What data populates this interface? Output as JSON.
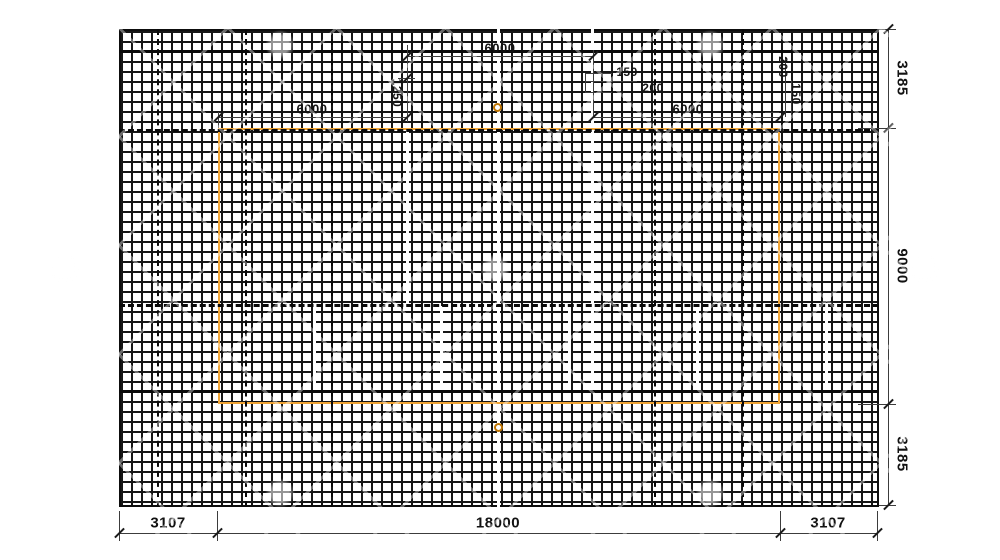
{
  "meta": {
    "kind": "reinforcement-mesh-layout-plan",
    "units": "mm"
  },
  "colors": {
    "grid_line": "#161616",
    "heavy_line": "#0a0a0a",
    "dim_line": "#3c3c3c",
    "text": "#121212",
    "outline_orange": "#f0a435",
    "circle_orange": "#bf7400",
    "background": "#ffffff"
  },
  "drawing": {
    "mesh": {
      "x": 119,
      "y": 29,
      "w": 760,
      "h": 478
    },
    "inner_outline": {
      "x": 218,
      "y": 128,
      "w": 562,
      "h": 276
    },
    "heavy_hlines": [
      {
        "x1": 119,
        "x2": 879,
        "y": 51,
        "t": 3,
        "style": "solid"
      },
      {
        "x1": 119,
        "x2": 879,
        "y": 130,
        "t": 3,
        "style": "dashed"
      },
      {
        "x1": 119,
        "x2": 879,
        "y": 305,
        "t": 3,
        "style": "dashed"
      },
      {
        "x1": 119,
        "x2": 879,
        "y": 391,
        "t": 3,
        "style": "solid"
      }
    ],
    "dashed_vlines": [
      {
        "x": 158,
        "y1": 29,
        "y2": 507
      },
      {
        "x": 246,
        "y1": 29,
        "y2": 507
      },
      {
        "x": 332,
        "y1": 29,
        "y2": 507
      },
      {
        "x": 655,
        "y1": 29,
        "y2": 507
      },
      {
        "x": 743,
        "y1": 29,
        "y2": 507
      }
    ],
    "seams": [
      {
        "x": 407,
        "y1": 130,
        "y2": 306
      },
      {
        "x": 498,
        "y1": 29,
        "y2": 507
      },
      {
        "x": 592,
        "y1": 29,
        "y2": 391
      },
      {
        "x": 314,
        "y1": 306,
        "y2": 391
      },
      {
        "x": 441,
        "y1": 306,
        "y2": 391
      },
      {
        "x": 569,
        "y1": 306,
        "y2": 391
      },
      {
        "x": 697,
        "y1": 306,
        "y2": 391
      },
      {
        "x": 826,
        "y1": 306,
        "y2": 391
      }
    ],
    "circles": [
      {
        "cx": 497,
        "cy": 107,
        "d": 9
      },
      {
        "cx": 498,
        "cy": 427,
        "d": 9
      }
    ],
    "dim_hlines": [
      {
        "x1": 119,
        "x2": 877,
        "y": 533
      },
      {
        "x1": 218,
        "x2": 407,
        "y": 117
      },
      {
        "x1": 407,
        "x2": 593,
        "y": 56
      },
      {
        "x1": 593,
        "x2": 780,
        "y": 117
      },
      {
        "x1": 585,
        "x2": 612,
        "y": 73
      },
      {
        "x1": 585,
        "x2": 637,
        "y": 81
      },
      {
        "x1": 585,
        "x2": 612,
        "y": 92
      },
      {
        "x1": 765,
        "x2": 779,
        "y": 112
      },
      {
        "x1": 398,
        "x2": 415,
        "y": 78
      },
      {
        "x1": 879,
        "x2": 896,
        "y": 29
      },
      {
        "x1": 858,
        "x2": 896,
        "y": 128
      },
      {
        "x1": 858,
        "x2": 896,
        "y": 404
      },
      {
        "x1": 879,
        "x2": 896,
        "y": 505
      }
    ],
    "dim_vlines": [
      {
        "x": 888,
        "y1": 29,
        "y2": 505
      },
      {
        "x": 119,
        "y1": 511,
        "y2": 541
      },
      {
        "x": 217,
        "y1": 511,
        "y2": 541
      },
      {
        "x": 780,
        "y1": 511,
        "y2": 541
      },
      {
        "x": 877,
        "y1": 511,
        "y2": 541
      },
      {
        "x": 407,
        "y1": 45,
        "y2": 122
      },
      {
        "x": 593,
        "y1": 50,
        "y2": 117
      },
      {
        "x": 218,
        "y1": 112,
        "y2": 128
      },
      {
        "x": 785,
        "y1": 58,
        "y2": 117
      },
      {
        "x": 791,
        "y1": 80,
        "y2": 117
      },
      {
        "x": 585,
        "y1": 73,
        "y2": 92
      }
    ],
    "ticks": [
      {
        "x": 119,
        "y": 533
      },
      {
        "x": 217,
        "y": 533
      },
      {
        "x": 780,
        "y": 533
      },
      {
        "x": 877,
        "y": 533
      },
      {
        "x": 888,
        "y": 29
      },
      {
        "x": 888,
        "y": 128
      },
      {
        "x": 888,
        "y": 404
      },
      {
        "x": 888,
        "y": 505
      },
      {
        "x": 218,
        "y": 117
      },
      {
        "x": 407,
        "y": 117
      },
      {
        "x": 407,
        "y": 56
      },
      {
        "x": 593,
        "y": 56
      },
      {
        "x": 593,
        "y": 117
      },
      {
        "x": 780,
        "y": 117
      },
      {
        "x": 407,
        "y": 78
      }
    ],
    "labels": [
      {
        "name": "dim-bottom-left",
        "text": "3107",
        "x": 168,
        "y": 523,
        "rot": 0,
        "size": 15
      },
      {
        "name": "dim-bottom-center",
        "text": "18000",
        "x": 498,
        "y": 523,
        "rot": 0,
        "size": 15
      },
      {
        "name": "dim-bottom-right",
        "text": "3107",
        "x": 828,
        "y": 523,
        "rot": 0,
        "size": 15
      },
      {
        "name": "dim-right-top",
        "text": "3185",
        "x": 902,
        "y": 78,
        "rot": 90,
        "size": 15
      },
      {
        "name": "dim-right-middle",
        "text": "9000",
        "x": 902,
        "y": 266,
        "rot": 90,
        "size": 15
      },
      {
        "name": "dim-right-bottom",
        "text": "3185",
        "x": 902,
        "y": 454,
        "rot": 90,
        "size": 15
      },
      {
        "name": "dim-top-left-6000",
        "text": "6000",
        "x": 312,
        "y": 109,
        "rot": 0,
        "size": 13
      },
      {
        "name": "dim-top-center-6000",
        "text": "6000",
        "x": 500,
        "y": 48,
        "rot": 0,
        "size": 13
      },
      {
        "name": "dim-top-right-6000",
        "text": "6000",
        "x": 688,
        "y": 109,
        "rot": 0,
        "size": 13
      },
      {
        "name": "dim-1250",
        "text": "1250",
        "x": 397,
        "y": 93,
        "rot": 90,
        "size": 12
      },
      {
        "name": "dim-150-center",
        "text": "150",
        "x": 627,
        "y": 72,
        "rot": 0,
        "size": 12
      },
      {
        "name": "dim-200-center",
        "text": "200",
        "x": 653,
        "y": 88,
        "rot": 0,
        "size": 12
      },
      {
        "name": "dim-200-right",
        "text": "200",
        "x": 783,
        "y": 67,
        "rot": 90,
        "size": 12
      },
      {
        "name": "dim-150-right",
        "text": "150",
        "x": 796,
        "y": 94,
        "rot": 90,
        "size": 12
      }
    ]
  }
}
